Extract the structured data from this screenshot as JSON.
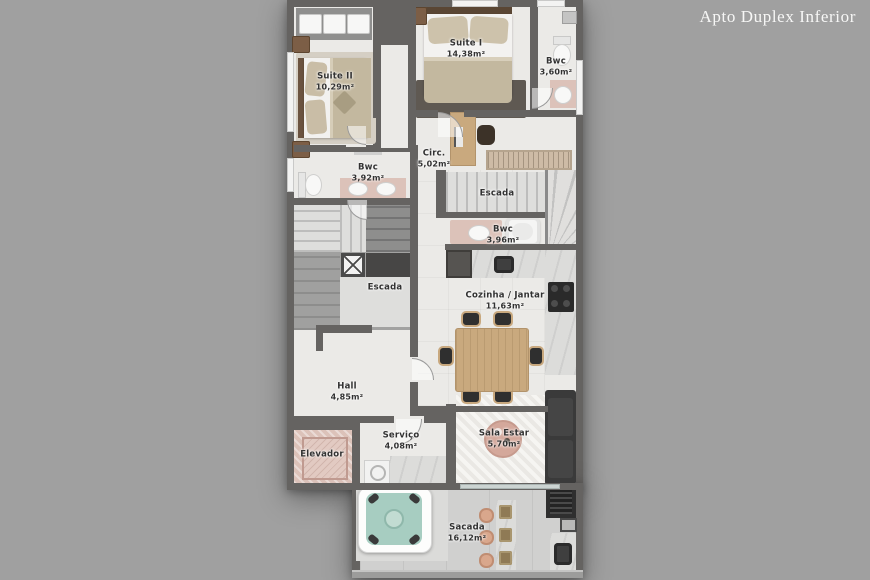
{
  "title": "Apto Duplex Inferior",
  "rooms": {
    "suite2": {
      "name": "Suite II",
      "area": "10,29m²"
    },
    "suite1": {
      "name": "Suite I",
      "area": "14,38m²"
    },
    "bwc1": {
      "name": "Bwc",
      "area": "3,60m²"
    },
    "circ": {
      "name": "Circ.",
      "area": "5,02m²"
    },
    "bwc2": {
      "name": "Bwc",
      "area": "3,92m²"
    },
    "escada_sup": {
      "name": "Escada"
    },
    "bwc3": {
      "name": "Bwc",
      "area": "3,96m²"
    },
    "escada_esq": {
      "name": "Escada"
    },
    "cozinha": {
      "name": "Cozinha / Jantar",
      "area": "11,63m²"
    },
    "hall": {
      "name": "Hall",
      "area": "4,85m²"
    },
    "elevador": {
      "name": "Elevador"
    },
    "servico": {
      "name": "Serviço",
      "area": "4,08m²"
    },
    "sala": {
      "name": "Sala Estar",
      "area": "5,70m²"
    },
    "sacada": {
      "name": "Sacada",
      "area": "16,12m²"
    }
  },
  "colors": {
    "pagebg": "#a0a0a0",
    "wall": "#656361",
    "floor": "#ebeae7",
    "pink": "#dcc2b9",
    "teal": "#a7cdc1",
    "wood": "#c9a97e",
    "marble": "#dcdcda",
    "dark": "#333333",
    "title": "#f7f7f6"
  }
}
